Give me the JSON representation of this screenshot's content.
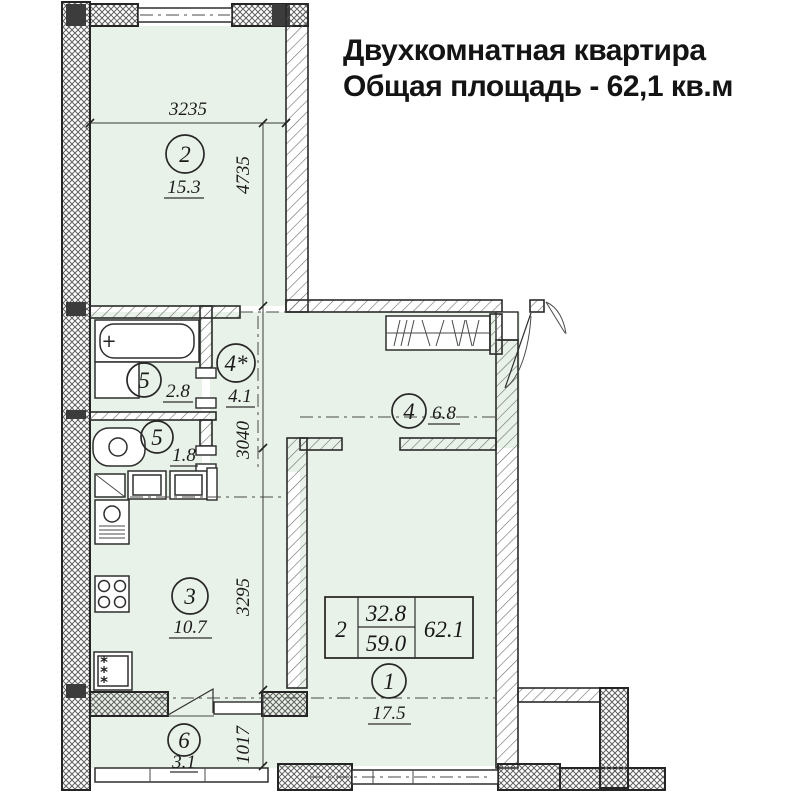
{
  "title": {
    "line1": "Двухкомнатная квартира",
    "line2": "Общая площадь - 62,1 кв.м"
  },
  "rooms": {
    "r2": {
      "number": "2",
      "area": "15.3"
    },
    "bath": {
      "number": "5",
      "area": "2.8"
    },
    "hallstar": {
      "number": "4*",
      "area": "4.1"
    },
    "wc": {
      "number": "5",
      "area": "1.8"
    },
    "corridor": {
      "number": "4",
      "area": "6.8"
    },
    "kitchen": {
      "number": "3",
      "area": "10.7"
    },
    "living": {
      "number": "1",
      "area": "17.5"
    },
    "balcony": {
      "number": "6",
      "area": "3.1"
    }
  },
  "dimensions": {
    "room2_width": "3235",
    "room2_depth": "4735",
    "hall_depth": "3040",
    "kitchen_depth": "3295",
    "balcony_depth": "1017"
  },
  "area_table": {
    "rooms_count": "2",
    "living_area": "32.8",
    "area_without_balcony": "59.0",
    "total_area": "62.1"
  },
  "icons": {
    "asterisk": "*",
    "tap_cross": "+"
  },
  "colors": {
    "room_fill": "#e9f2e8",
    "line": "#2a2a2a"
  }
}
